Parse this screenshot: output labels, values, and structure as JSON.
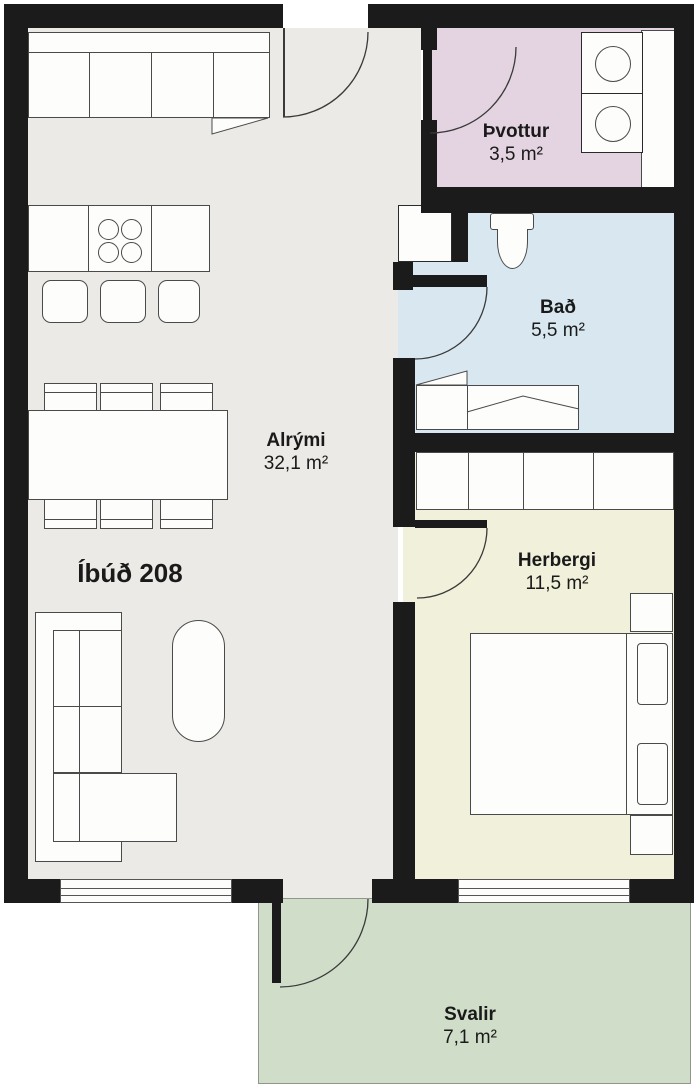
{
  "title": "Íbúð 208",
  "rooms": {
    "alrymi": {
      "name": "Alrými",
      "area": "32,1 m²",
      "color": "#ECEAE6"
    },
    "thvottur": {
      "name": "Þvottur",
      "area": "3,5 m²",
      "color": "#E4D3E0"
    },
    "bad": {
      "name": "Bað",
      "area": "5,5 m²",
      "color": "#D8E7F0"
    },
    "herbergi": {
      "name": "Herbergi",
      "area": "11,5 m²",
      "color": "#F1F0DB"
    },
    "svalir": {
      "name": "Svalir",
      "area": "7,1 m²",
      "color": "#CFDDC9"
    }
  },
  "colors": {
    "wall": "#1B1B1B",
    "furniture_fill": "#FDFDFC",
    "furniture_outline": "#4A4A4A",
    "door_arc": "#3A3A3A",
    "outside": "#FFFFFF"
  }
}
